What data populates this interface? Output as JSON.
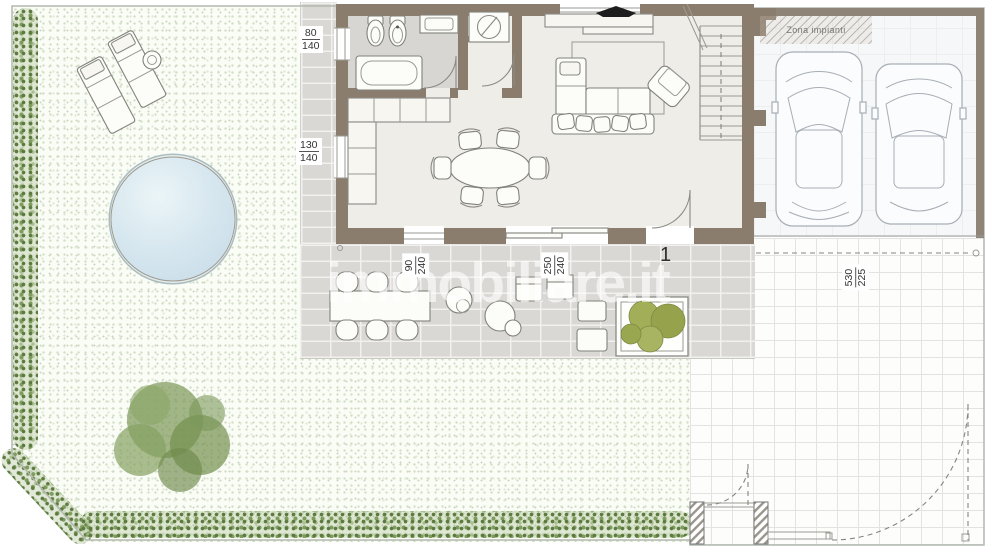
{
  "watermark": "immobiliare.it",
  "unit_number": "1",
  "areas": {
    "garage_note": "Zona impianti"
  },
  "dimensions": {
    "bath_window": {
      "num": "80",
      "den": "140"
    },
    "kitchen_window": {
      "num": "130",
      "den": "140"
    },
    "living_window": {
      "num": "90",
      "den": "240"
    },
    "sliding_door": {
      "num": "250",
      "den": "240"
    },
    "driveway": {
      "num": "530",
      "den": "225"
    }
  },
  "colors": {
    "wall": "#8b7d6d",
    "pool_water": "#d4e5ee",
    "hedge_green": "#7e9c5e",
    "bush_olive": "#9aa751",
    "terrace_paver": "#d9d8d5",
    "garden_base": "#fafcf6"
  }
}
